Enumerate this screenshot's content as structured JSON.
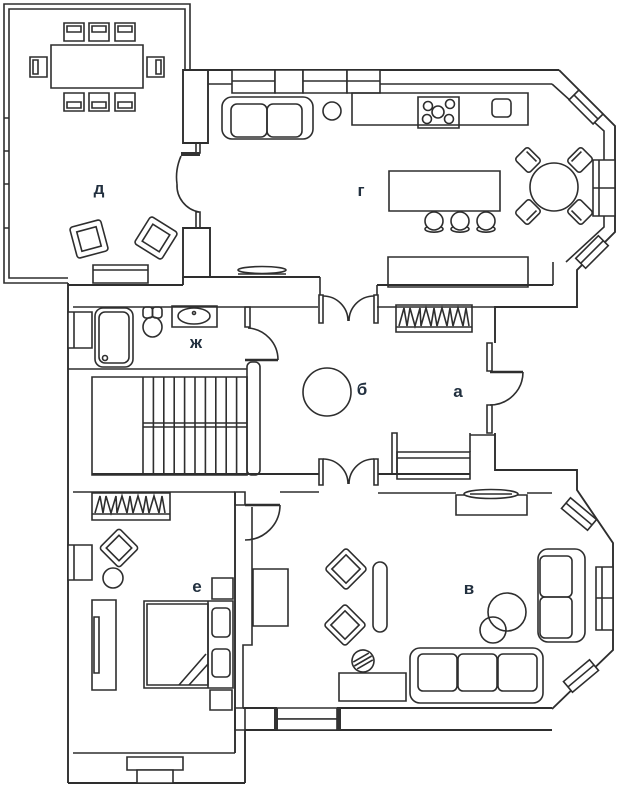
{
  "plan": {
    "type": "floor-plan",
    "colors": {
      "label": "#22303f",
      "line": "#2e2e2e",
      "background": "#ffffff"
    },
    "rooms": [
      {
        "id": "d",
        "label": "д"
      },
      {
        "id": "g",
        "label": "г"
      },
      {
        "id": "zh",
        "label": "ж"
      },
      {
        "id": "b",
        "label": "б"
      },
      {
        "id": "a",
        "label": "а"
      },
      {
        "id": "e",
        "label": "е"
      },
      {
        "id": "v",
        "label": "в"
      }
    ]
  }
}
